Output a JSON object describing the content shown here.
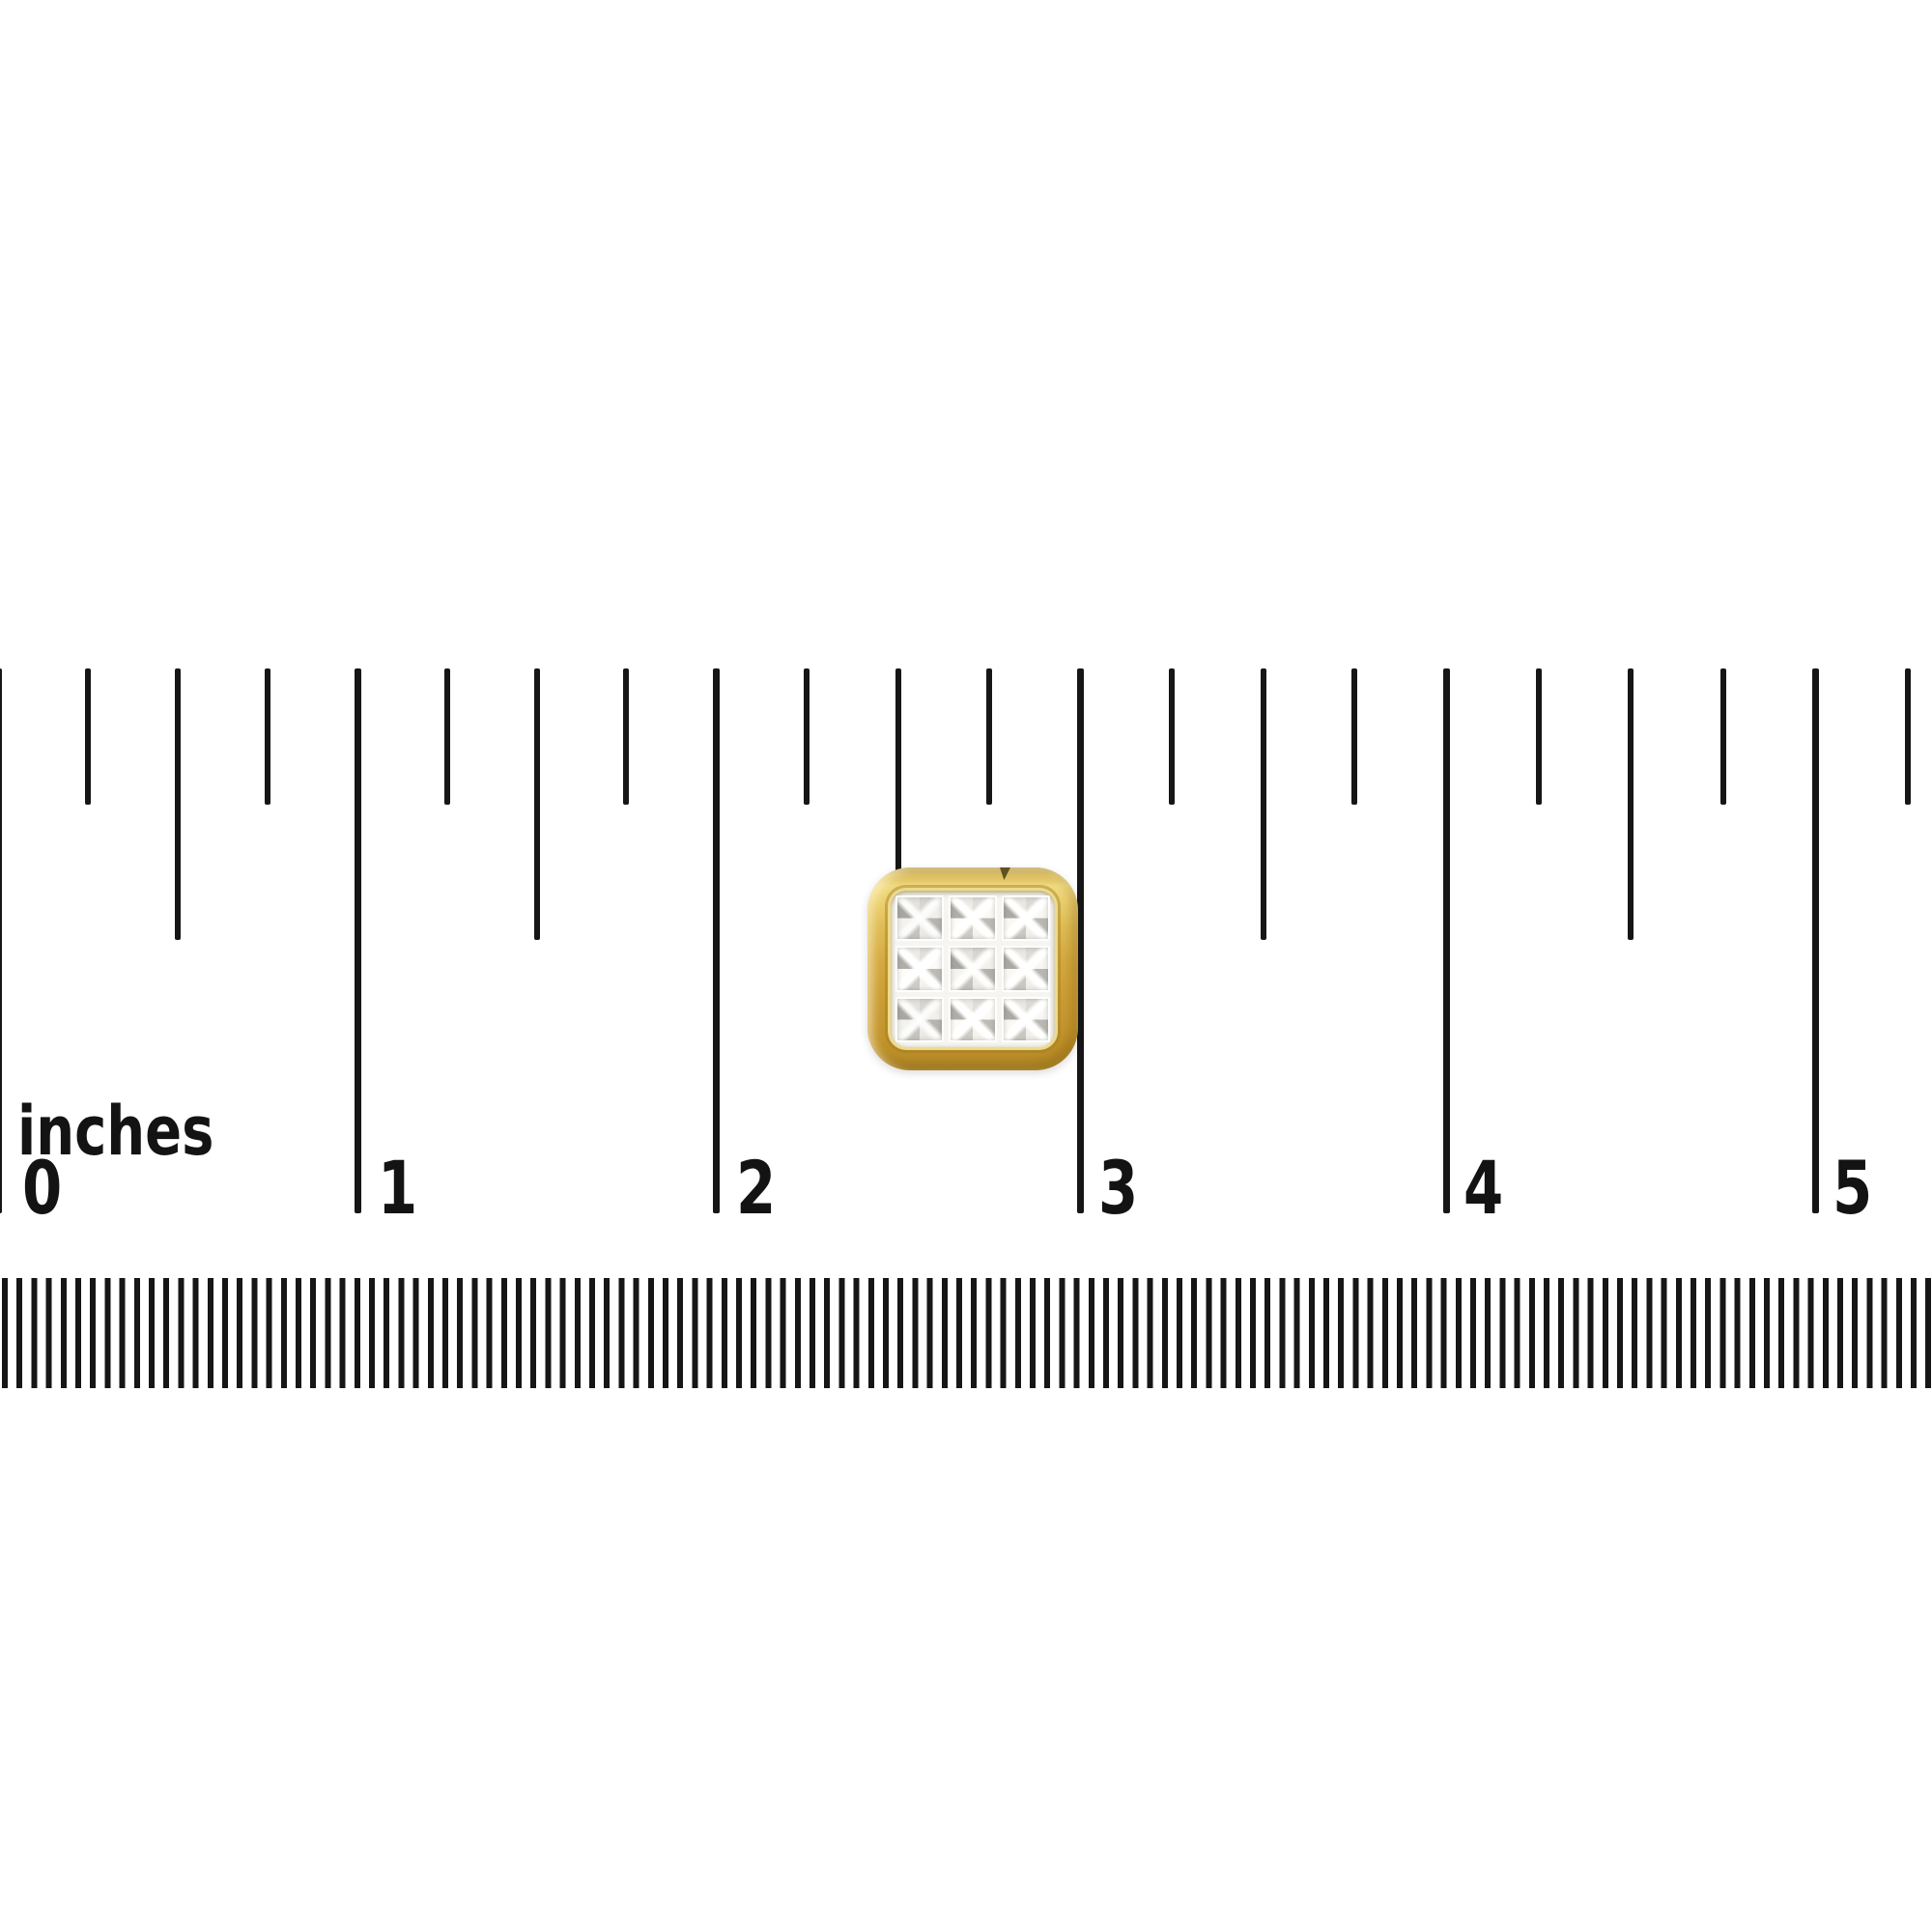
{
  "colors": {
    "background": "#ffffff",
    "tick": "#161616",
    "gold": "#d2a53c",
    "gold_light": "#f0d97f",
    "gold_dark": "#aa8426",
    "diamond_base": "#efeeea",
    "diamond_shadow": "#a9a7a2"
  },
  "ruler_inches": {
    "unit_label": "inches",
    "labels": [
      "0",
      "1",
      "2",
      "3",
      "4",
      "5"
    ]
  },
  "item": {
    "description": "Square yellow-gold stud with 3x3 princess-cut diamond cluster"
  }
}
